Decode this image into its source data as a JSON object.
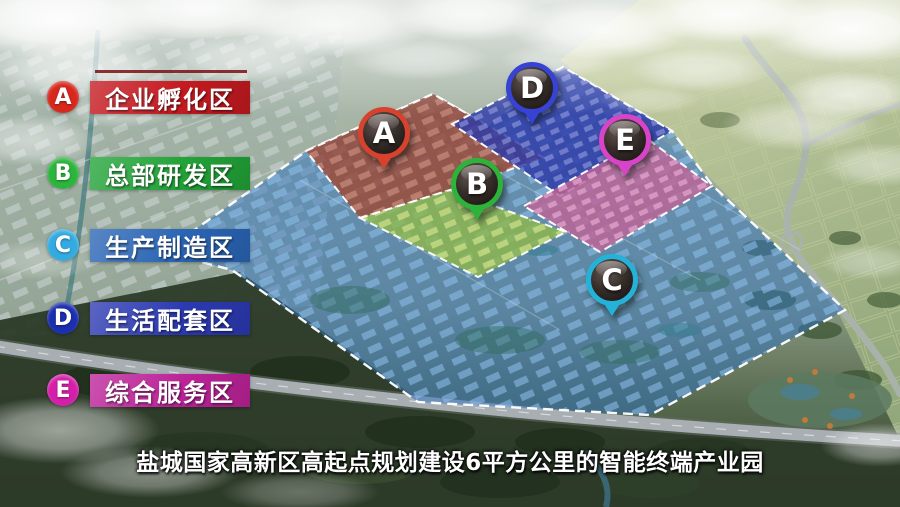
{
  "caption": {
    "text": "盐城国家高新区高起点规划建设6平方公里的智能终端产业园"
  },
  "legend": {
    "items": [
      {
        "letter": "A",
        "label": "企业孵化区",
        "circle_color": "#d8271d",
        "banner_color": "#c41a20"
      },
      {
        "letter": "B",
        "label": "总部研发区",
        "circle_color": "#2cb53c",
        "banner_color": "#22a338"
      },
      {
        "letter": "C",
        "label": "生产制造区",
        "circle_color": "#34abe0",
        "banner_color": "#2a65b5"
      },
      {
        "letter": "D",
        "label": "生活配套区",
        "circle_color": "#1c2fae",
        "banner_color": "#2c3ab2"
      },
      {
        "letter": "E",
        "label": "综合服务区",
        "circle_color": "#d420a8",
        "banner_color": "#bc2398"
      }
    ]
  },
  "pins": [
    {
      "letter": "A",
      "color": "#d6422e"
    },
    {
      "letter": "B",
      "color": "#2db33a"
    },
    {
      "letter": "C",
      "color": "#25b2d8"
    },
    {
      "letter": "D",
      "color": "#3743d4"
    },
    {
      "letter": "E",
      "color": "#d844c8"
    }
  ],
  "zones": [
    {
      "id": "A",
      "label": "企业孵化区",
      "fill": "#9c4936"
    },
    {
      "id": "B",
      "label": "总部研发区",
      "fill": "#8fb84a"
    },
    {
      "id": "C",
      "label": "生产制造区",
      "fill": "#2e72c0"
    },
    {
      "id": "D",
      "label": "生活配套区",
      "fill": "#2d3aa8"
    },
    {
      "id": "E",
      "label": "综合服务区",
      "fill": "#bd6496"
    }
  ]
}
